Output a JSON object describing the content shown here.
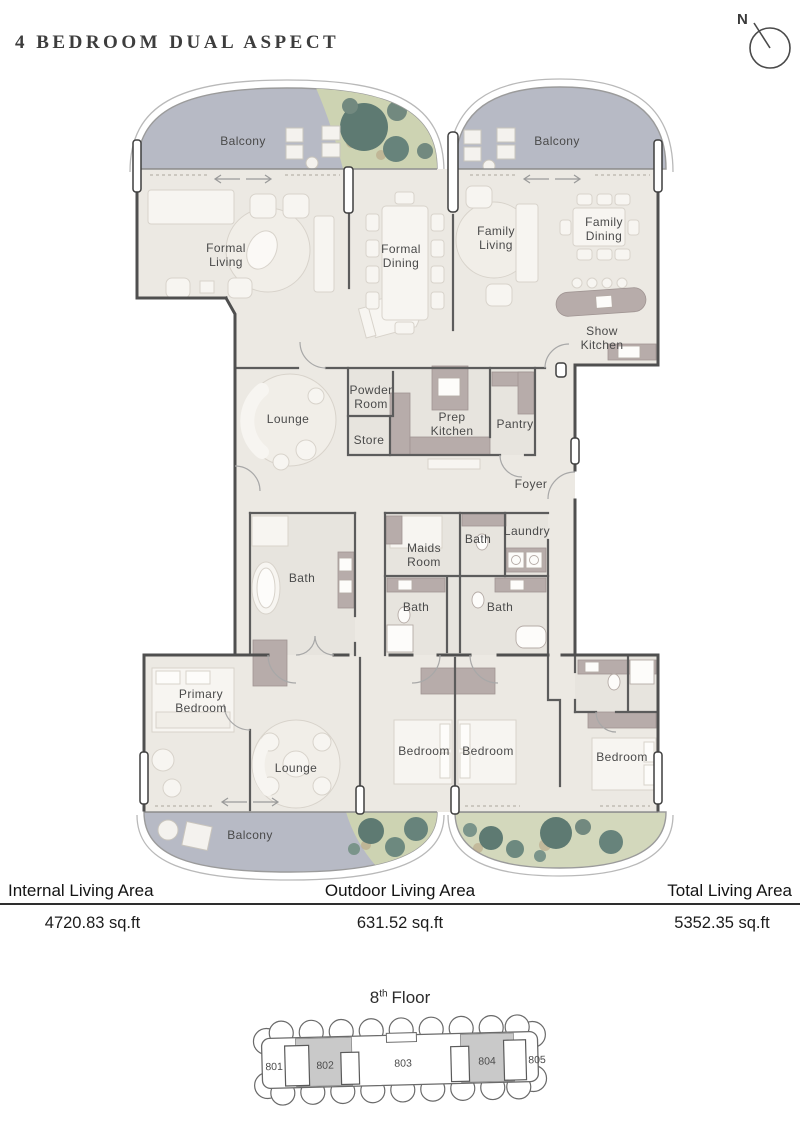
{
  "header": {
    "title": "4 BEDROOM DUAL ASPECT",
    "compass": "N"
  },
  "rooms": {
    "balcony_top_left": "Balcony",
    "balcony_top_right": "Balcony",
    "formal_living": "Formal\nLiving",
    "formal_dining": "Formal\nDining",
    "family_living": "Family\nLiving",
    "family_dining": "Family\nDining",
    "show_kitchen": "Show\nKitchen",
    "lounge_upper": "Lounge",
    "powder_room": "Powder\nRoom",
    "store": "Store",
    "prep_kitchen": "Prep\nKitchen",
    "pantry": "Pantry",
    "foyer": "Foyer",
    "bath_primary": "Bath",
    "maids_room": "Maids\nRoom",
    "bath_2": "Bath",
    "laundry": "Laundry",
    "bath_3": "Bath",
    "bath_4": "Bath",
    "primary_bedroom": "Primary\nBedroom",
    "lounge_lower": "Lounge",
    "bedroom_1": "Bedroom",
    "bedroom_2": "Bedroom",
    "bedroom_3": "Bedroom",
    "balcony_bottom": "Balcony"
  },
  "stats": [
    {
      "label": "Internal Living Area",
      "value": "4720.83 sq.ft"
    },
    {
      "label": "Outdoor Living Area",
      "value": "631.52 sq.ft"
    },
    {
      "label": "Total Living Area",
      "value": "5352.35 sq.ft"
    }
  ],
  "keyplan": {
    "floor_number": "8",
    "floor_suffix": "th",
    "floor_word": "Floor",
    "units": [
      {
        "number": "801",
        "highlighted": false
      },
      {
        "number": "802",
        "highlighted": true
      },
      {
        "number": "803",
        "highlighted": false
      },
      {
        "number": "804",
        "highlighted": true
      },
      {
        "number": "805",
        "highlighted": false
      }
    ]
  },
  "colors": {
    "balcony": "#b7bac5",
    "floor": "#ece9e3",
    "greenery": "#cdd3b2",
    "tree_dark": "#5e7a72",
    "tree_light": "#72897f",
    "wall": "#4f4f4f",
    "counter_mauve": "#b7acaa",
    "unit_highlight": "#c9c9c9"
  }
}
